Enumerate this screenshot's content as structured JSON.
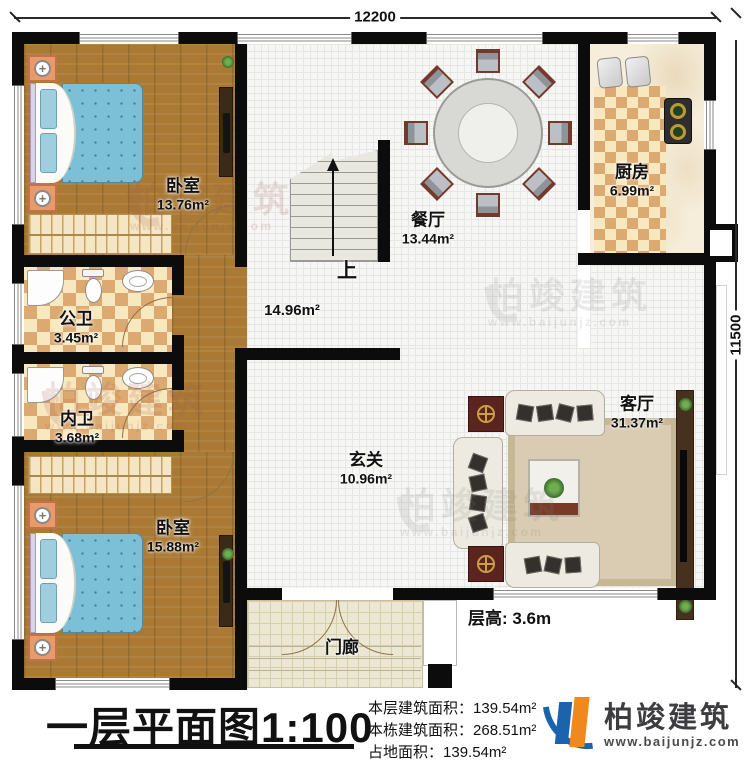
{
  "dimensions": {
    "width_mm": "12200",
    "height_mm": "11500"
  },
  "rooms": {
    "bedroom_tl": {
      "name": "卧室",
      "area": "13.76m²"
    },
    "bedroom_bl": {
      "name": "卧室",
      "area": "15.88m²"
    },
    "dining": {
      "name": "餐厅",
      "area": "13.44m²"
    },
    "kitchen": {
      "name": "厨房",
      "area": "6.99m²"
    },
    "public_bath": {
      "name": "公卫",
      "area": "3.45m²"
    },
    "private_bath": {
      "name": "内卫",
      "area": "3.68m²"
    },
    "hall": {
      "area": "14.96m²"
    },
    "foyer": {
      "name": "玄关",
      "area": "10.96m²"
    },
    "living": {
      "name": "客厅",
      "area": "31.37m²"
    },
    "porch": {
      "name": "门廊"
    }
  },
  "stairs": {
    "direction_label": "上"
  },
  "annotations": {
    "floor_height": "层高: 3.6m"
  },
  "title_block": {
    "title": "一层平面图",
    "scale": "1:100",
    "stats": [
      {
        "label": "本层建筑面积：",
        "value": "139.54m²"
      },
      {
        "label": "本栋建筑面积：",
        "value": "268.51m²"
      },
      {
        "label": "占地面积：",
        "value": "139.54m²"
      }
    ],
    "brand": {
      "name": "柏竣建筑",
      "url": "www.baijunjz.com"
    }
  },
  "watermark": {
    "name": "柏竣建筑",
    "url": "www.baijunjz.com"
  },
  "colors": {
    "wall": "#0c0c0c",
    "wood_floor": "#aa7a34",
    "checker_tan": "#dcaa70",
    "quilt_blue": "#7cc0d8",
    "brand_blue": "#1b63ac",
    "brand_orange": "#f0891d"
  }
}
